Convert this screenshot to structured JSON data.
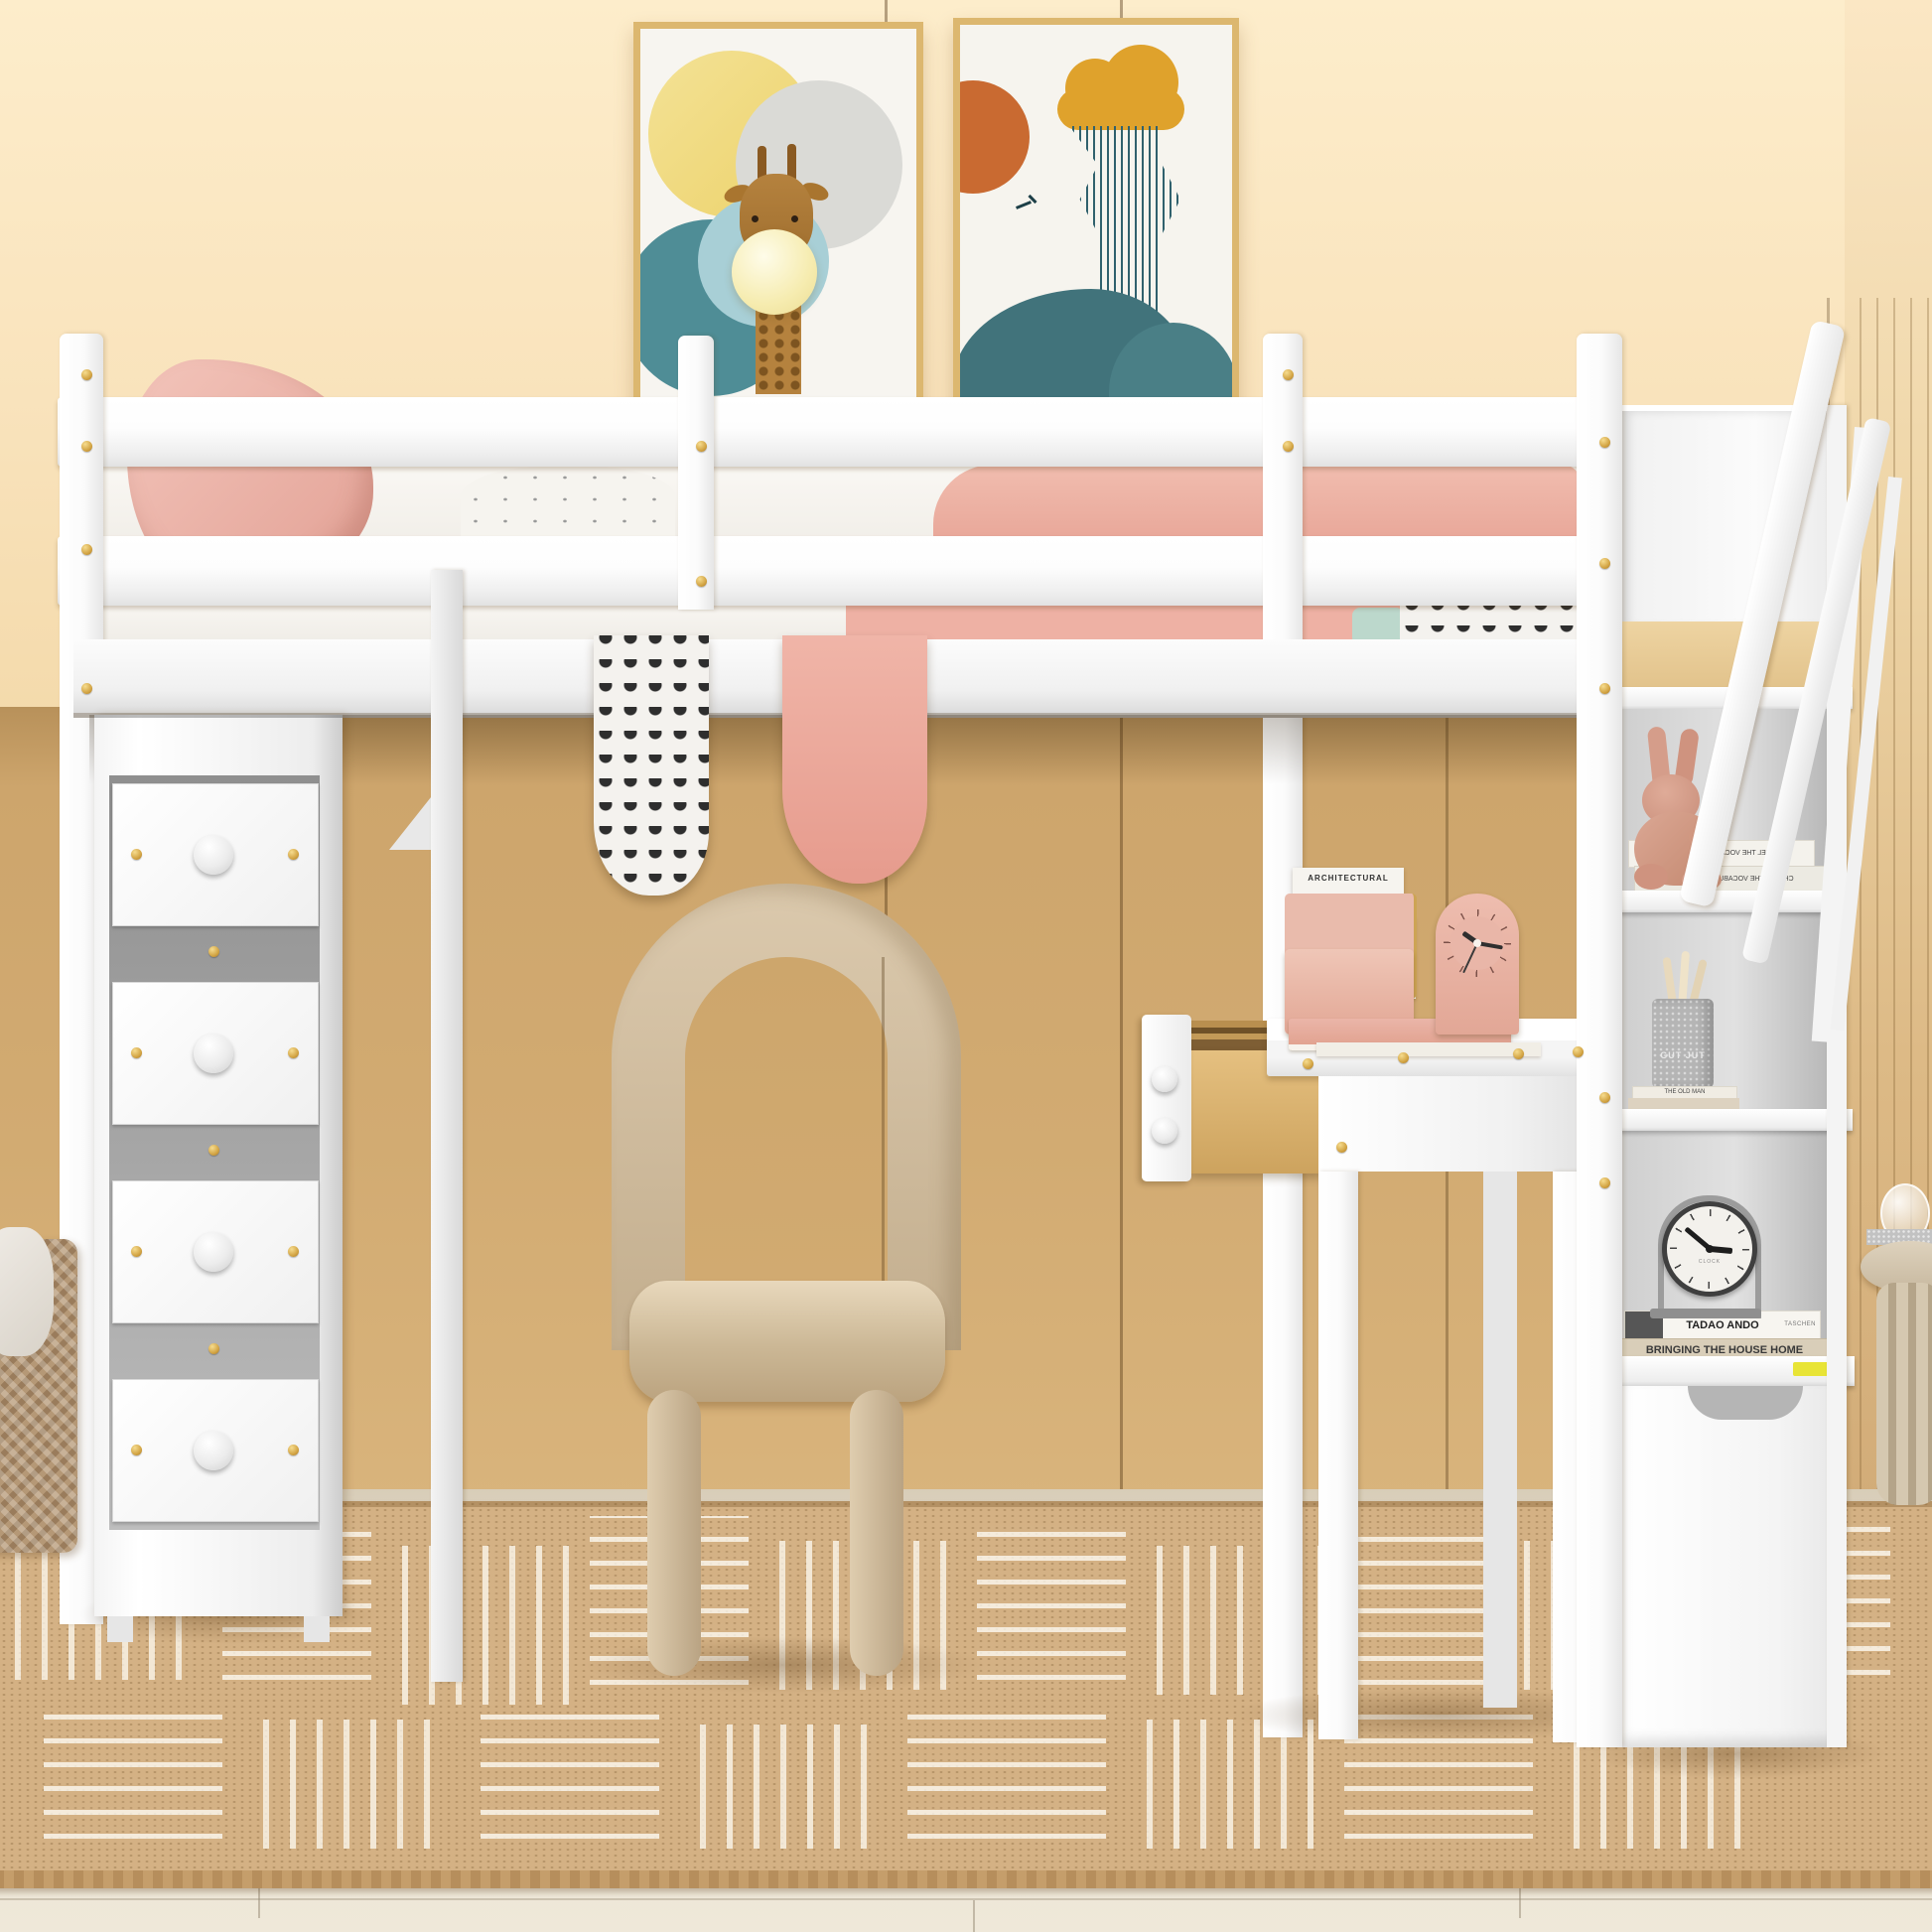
{
  "scene": {
    "alt": "Kids bedroom photo: white twin loft bed with guardrails over a desk area, four-drawer chest on the left, storage staircase with shelves on the right, beige arch chair, two art prints on a peach wall, jute rug on light wood floor",
    "colors": {
      "wall": "#f8e2ba",
      "wall_shadowed": "#cfa76e",
      "frame_gold": "#dcb76f",
      "furniture_white": "#ffffff",
      "pink_textile": "#eeb1a4",
      "teal_art": "#41737b",
      "mustard_art": "#dfa22c",
      "orange_art": "#c96a31",
      "chair_beige": "#cdb99c",
      "drawer_wood": "#d9b172",
      "rug_jute": "#d4b184",
      "hardware_gold": "#d3a545"
    }
  },
  "art": {
    "left_print": "giraffe-bubblegum-print",
    "right_print": "abstract-rain-mountain-print"
  },
  "texts": {
    "architectural_big": "ARCHITECTURAL",
    "architectural_small": "ARCHITECTURAL",
    "chanel_1": "CHANEL  THE VOCABULARY OF STYLE",
    "chanel_2": "CHANEL  THE VOCABULARY OF STYLE",
    "pencil_cup": "GUT JUT",
    "old_man": "THE OLD MAN",
    "tadao": "TADAO ANDO",
    "taschen": "TASCHEN",
    "bringing": "BRINGING THE HOUSE HOME",
    "clock_label": "CLOCK"
  },
  "clocks": {
    "desk_clock": {
      "hour_deg": -55,
      "minute_deg": 100,
      "second_deg": 205
    },
    "shelf_clock": {
      "hour_deg": 95,
      "minute_deg": -50
    }
  }
}
